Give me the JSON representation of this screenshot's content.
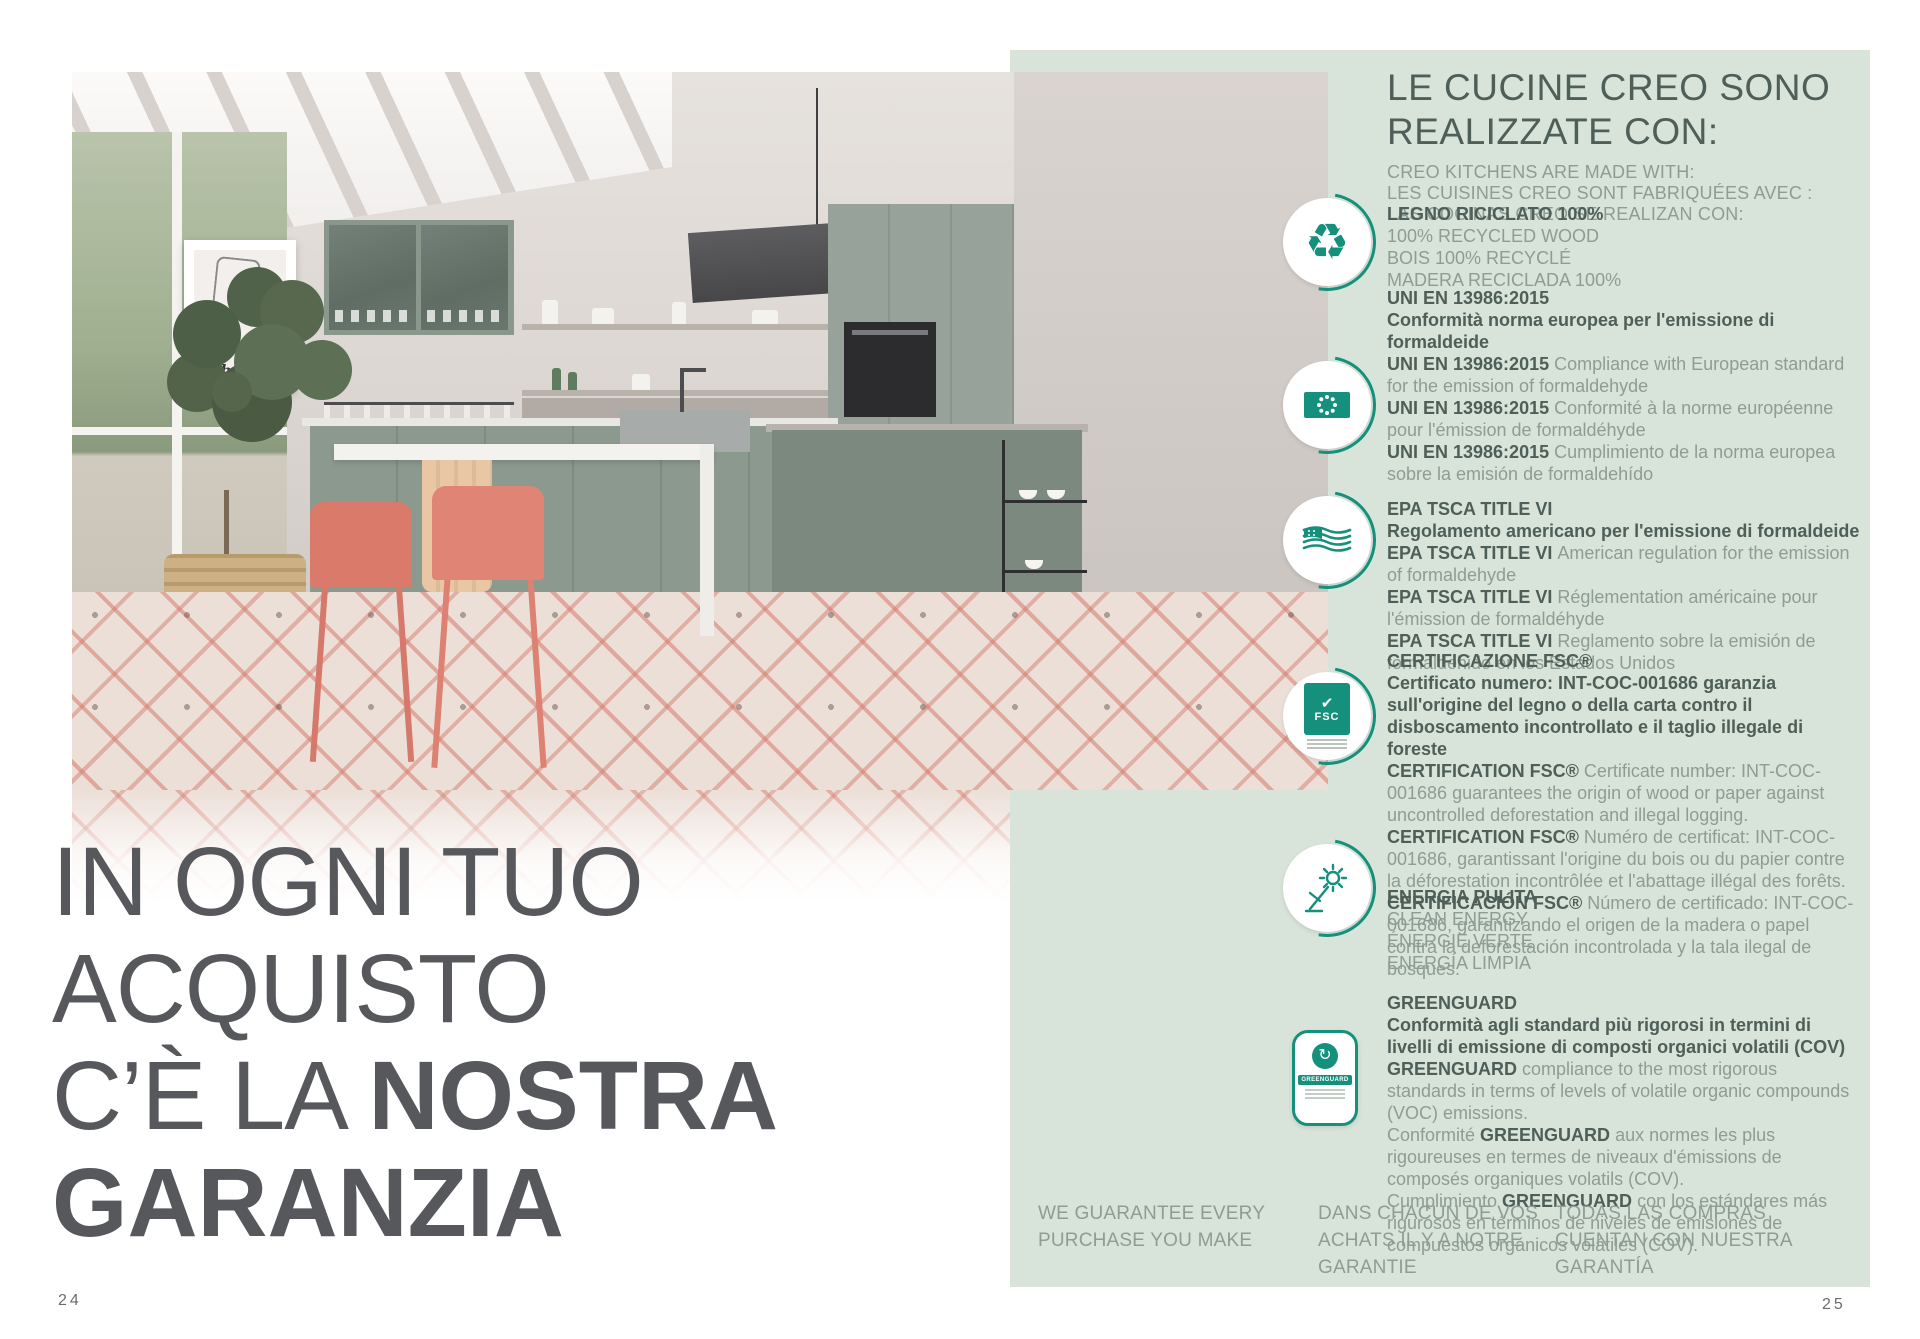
{
  "colors": {
    "panel_green": "#d8e4d9",
    "accent_teal": "#15907c",
    "heading_dark": "#4e5e58",
    "body_muted": "#8d9c94",
    "headline_gray": "#57585c"
  },
  "page": {
    "left_number": "24",
    "right_number": "25"
  },
  "left_page": {
    "headline": {
      "line1": "IN OGNI TUO",
      "line2": "ACQUISTO",
      "line3_light": "C’È LA ",
      "line3_bold": "NOSTRA",
      "line4": "GARANZIA"
    },
    "photo": {
      "poster_text": "Thonet"
    }
  },
  "icon_labels": {
    "fsc": "FSC",
    "greenguard": "GREENGUARD"
  },
  "right_panel": {
    "title_line1": "LE CUCINE CREO SONO",
    "title_line2": "REALIZZATE CON:",
    "subtitle_lines": [
      "CREO KITCHENS ARE MADE WITH:",
      "LES CUISINES CREO SONT FABRIQUÉES AVEC :",
      "LAS COCINAS CREO SE REALIZAN CON:"
    ],
    "certifications": [
      {
        "icon": "recycle-icon",
        "bold_lines": [
          "LEGNO RICICLATO 100%"
        ],
        "entries": [
          {
            "segments": [
              {
                "b": false,
                "t": "100% RECYCLED WOOD"
              }
            ]
          },
          {
            "segments": [
              {
                "b": false,
                "t": "BOIS 100% RECYCLÉ"
              }
            ]
          },
          {
            "segments": [
              {
                "b": false,
                "t": "MADERA RECICLADA 100%"
              }
            ]
          }
        ]
      },
      {
        "icon": "eu-flag-icon",
        "bold_lines": [
          "UNI EN 13986:2015",
          "Conformità norma europea per l'emissione di formaldeide"
        ],
        "entries": [
          {
            "segments": [
              {
                "b": true,
                "t": "UNI EN 13986:2015 "
              },
              {
                "b": false,
                "t": "Compliance with European standard for the emission of formaldehyde"
              }
            ]
          },
          {
            "segments": [
              {
                "b": true,
                "t": "UNI EN 13986:2015 "
              },
              {
                "b": false,
                "t": "Conformité à la norme européenne pour l'émission de formaldéhyde"
              }
            ]
          },
          {
            "segments": [
              {
                "b": true,
                "t": "UNI EN 13986:2015 "
              },
              {
                "b": false,
                "t": "Cumplimiento de la norma europea sobre la emisión de formaldehído"
              }
            ]
          }
        ]
      },
      {
        "icon": "us-flag-icon",
        "bold_lines": [
          "EPA TSCA  TITLE VI",
          "Regolamento americano per l'emissione di formaldeide"
        ],
        "entries": [
          {
            "segments": [
              {
                "b": true,
                "t": "EPA TSCA TITLE VI "
              },
              {
                "b": false,
                "t": "American regulation for the emission of formaldehyde"
              }
            ]
          },
          {
            "segments": [
              {
                "b": true,
                "t": "EPA TSCA TITLE VI "
              },
              {
                "b": false,
                "t": "Réglementation américaine pour l'émission de formaldéhyde"
              }
            ]
          },
          {
            "segments": [
              {
                "b": true,
                "t": "EPA TSCA TITLE VI "
              },
              {
                "b": false,
                "t": "Reglamento sobre la emisión de formaldehido en los Estados Unidos"
              }
            ]
          }
        ]
      },
      {
        "icon": "fsc-icon",
        "bold_lines": [
          "CERTIFICAZIONE FSC®",
          "Certificato numero: INT-COC-001686 garanzia sull'origine del legno o della carta contro il disboscamento incontrollato e il taglio illegale di foreste"
        ],
        "entries": [
          {
            "segments": [
              {
                "b": true,
                "t": "CERTIFICATION FSC® "
              },
              {
                "b": false,
                "t": "Certificate number: INT-COC-001686 guarantees the origin of wood or paper against uncontrolled deforestation and illegal logging."
              }
            ]
          },
          {
            "segments": [
              {
                "b": true,
                "t": "CERTIFICATION FSC® "
              },
              {
                "b": false,
                "t": "Numéro de certificat: INT-COC-001686, garantissant l'origine du bois ou du papier contre la déforestation incontrôlée et l'abattage illégal des forêts."
              }
            ]
          },
          {
            "segments": [
              {
                "b": true,
                "t": "CERTIFICACIÓN FSC® "
              },
              {
                "b": false,
                "t": "Número de certificado: INT-COC-001686, garantizando el origen de la madera o papel contra la deforestación incontrolada y la tala ilegal de bosques."
              }
            ]
          }
        ]
      },
      {
        "icon": "clean-energy-icon",
        "bold_lines": [
          "ENERGIA PULITA"
        ],
        "entries": [
          {
            "segments": [
              {
                "b": false,
                "t": "CLEAN ENERGY"
              }
            ]
          },
          {
            "segments": [
              {
                "b": false,
                "t": "ÉNERGIE VERTE"
              }
            ]
          },
          {
            "segments": [
              {
                "b": false,
                "t": "ENERGÍA LIMPIA"
              }
            ]
          }
        ]
      },
      {
        "icon": "greenguard-icon",
        "bold_lines": [
          "GREENGUARD",
          "Conformità agli standard più rigorosi in termini di livelli di emissione di composti organici volatili (COV)"
        ],
        "entries": [
          {
            "segments": [
              {
                "b": true,
                "t": "GREENGUARD "
              },
              {
                "b": false,
                "t": "compliance to the most rigorous standards in terms of levels of volatile organic compounds (VOC) emissions."
              }
            ]
          },
          {
            "segments": [
              {
                "b": false,
                "t": "Conformité "
              },
              {
                "b": true,
                "t": "GREENGUARD "
              },
              {
                "b": false,
                "t": "aux normes les plus rigoureuses en termes de niveaux d'émissions de composés organiques volatils (COV)."
              }
            ]
          },
          {
            "segments": [
              {
                "b": false,
                "t": "Cumplimiento "
              },
              {
                "b": true,
                "t": "GREENGUARD "
              },
              {
                "b": false,
                "t": "con los estándares más rigurosos en términos de niveles de emisiones de compuestos orgánicos volátiles (COV)."
              }
            ]
          }
        ]
      }
    ],
    "footer_columns": [
      {
        "lines": [
          "WE GUARANTEE EVERY",
          "PURCHASE YOU MAKE"
        ]
      },
      {
        "lines": [
          "DANS CHACUN DE VOS",
          "ACHATS IL Y A NOTRE",
          "GARANTIE"
        ]
      },
      {
        "lines": [
          "TODAS LAS COMPRAS",
          "CUENTAN CON NUESTRA",
          "GARANTÍA"
        ]
      }
    ]
  }
}
